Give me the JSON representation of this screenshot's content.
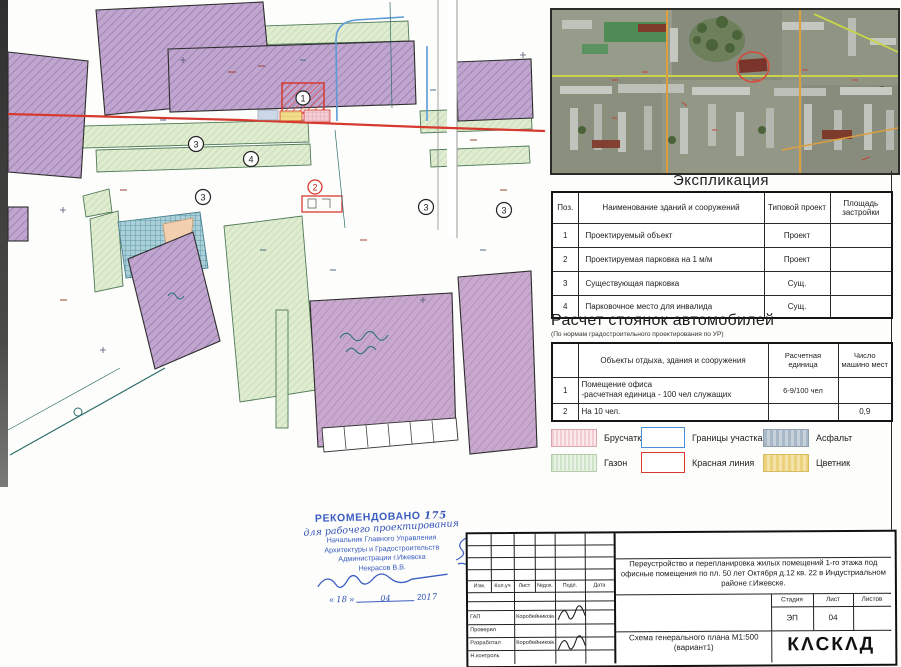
{
  "colors": {
    "stamp_blue": "#3b5ec0",
    "red_line": "#d63a2e",
    "boundary_blue": "#5b9bd5",
    "building_purple": "#bfa3cf",
    "lawn_green": "#dcead6",
    "asphalt_blue": "#a8cdd6",
    "flower_yellow": "#f2dc8c",
    "paving_pink": "#f3cdd3"
  },
  "map": {
    "markers": {
      "project": "1",
      "parking_new": "2",
      "parking_exist": "3",
      "disabled_spot": "4"
    }
  },
  "explication": {
    "title": "Экспликация",
    "columns": {
      "pos": "Поз.",
      "name": "Наименование зданий и сооружений",
      "project": "Типовой проект",
      "area": "Площадь застройки"
    },
    "rows": [
      {
        "pos": "1",
        "name": "Проектируемый объект",
        "project": "Проект",
        "area": ""
      },
      {
        "pos": "2",
        "name": "Проектируемая парковка на 1 м/м",
        "project": "Проект",
        "area": ""
      },
      {
        "pos": "3",
        "name": "Существующая парковка",
        "project": "Сущ.",
        "area": ""
      },
      {
        "pos": "4",
        "name": "Парковочное место для инвалида",
        "project": "Сущ.",
        "area": ""
      }
    ]
  },
  "parking_calc": {
    "title": "Расчет стоянок автомобилей",
    "subtitle": "(По нормам градостроительного проектирования по УР)",
    "columns": {
      "pos": "",
      "name": "Объекты отдыха, здания и сооружения",
      "unit": "Расчетная единица",
      "count": "Число машино мест"
    },
    "rows": [
      {
        "pos": "1",
        "name_line1": "Помещение офиса",
        "name_line2": "-расчетная единица - 100 чел служащих",
        "unit": "6-9/100 чел",
        "count": ""
      },
      {
        "pos": "2",
        "name_line1": "На 10 чел.",
        "name_line2": "",
        "unit": "",
        "count": "0,9"
      }
    ]
  },
  "legend": {
    "items": [
      {
        "label": "Брусчатка"
      },
      {
        "label": "Границы участка"
      },
      {
        "label": "Асфальт"
      },
      {
        "label": "Газон"
      },
      {
        "label": "Красная линия"
      },
      {
        "label": "Цветник"
      }
    ]
  },
  "approval_stamp": {
    "title": "РЕКОМЕНДОВАНО",
    "number": "175",
    "handwritten": "для рабочего проектирования",
    "official_lines": [
      "Начальник Главного Управления",
      "Архитектуры и Градостроительств",
      "Администрации г.Ижевска",
      "Некрасов В.В."
    ],
    "quote_open": "«",
    "quote_close": "»",
    "date_day": "18",
    "date_month": "04",
    "date_year_prefix": "20",
    "date_year_suffix": "17"
  },
  "titleblock": {
    "revision_cols": [
      "Изм.",
      "Кол.уч",
      "Лист",
      "№док.",
      "Подп.",
      "Дата"
    ],
    "project_title": "Переустройство и перепланировка жилых помещений 1-го этажа под  офисные помещения  по пл. 50 лет Октября  д.12 кв. 22  в Индустриальном районе   г.Ижевске.",
    "stage_label": "Стадия",
    "sheet_label": "Лист",
    "sheets_label": "Листов",
    "stage_value": "ЭП",
    "sheet_value": "04",
    "sheets_value": "",
    "scheme_title": "Схема генерального плана М1:500",
    "scheme_variant": "(вариант1)",
    "logo": "КΛСКΛД",
    "staff": [
      {
        "role": "ГАП",
        "name": "Коробейникова"
      },
      {
        "role": "Проверил",
        "name": ""
      },
      {
        "role": "Разработал",
        "name": "Коробейникова"
      },
      {
        "role": "Н.контроль",
        "name": ""
      }
    ]
  }
}
